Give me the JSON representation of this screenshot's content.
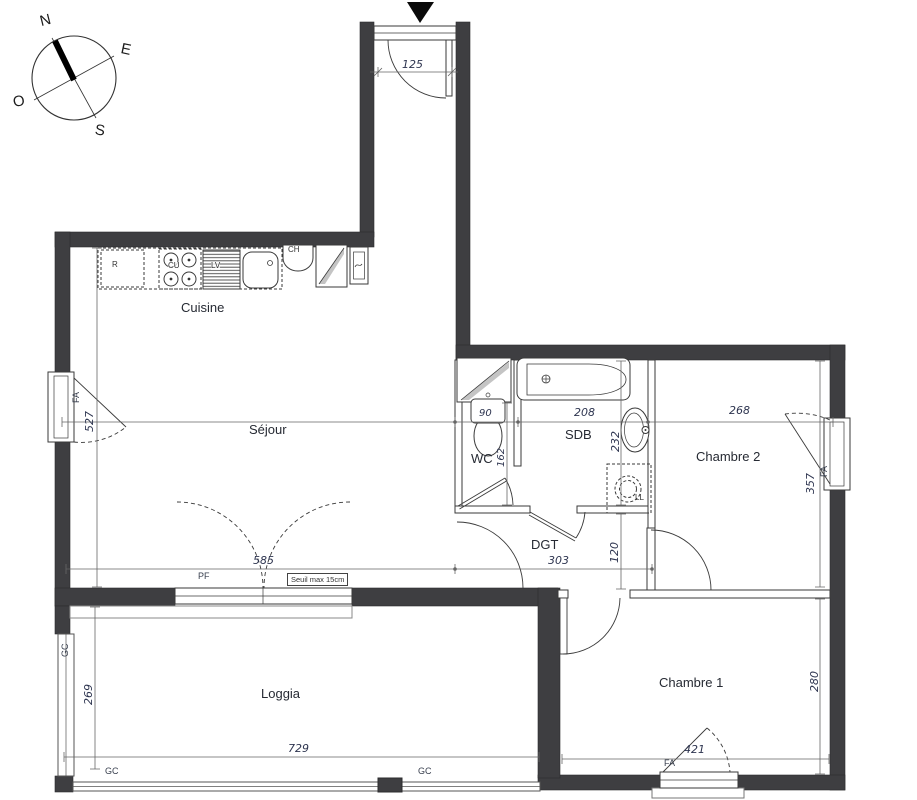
{
  "compass": {
    "north": "N",
    "east": "E",
    "west": "O",
    "south": "S"
  },
  "rooms": {
    "cuisine": "Cuisine",
    "sejour": "Séjour",
    "wc": "WC",
    "sdb": "SDB",
    "dgt": "DGT",
    "chambre2": "Chambre 2",
    "chambre1": "Chambre 1",
    "loggia": "Loggia"
  },
  "dimensions_cm": {
    "entrance_door": "125",
    "sejour_width": "585",
    "sejour_height": "527",
    "wc_width": "90",
    "wc_height": "162",
    "sdb_width": "208",
    "sdb_height": "232",
    "chambre2_width": "268",
    "chambre2_height": "357",
    "dgt_width": "303",
    "dgt_height": "120",
    "chambre1_width": "421",
    "chambre1_height": "280",
    "loggia_width": "729",
    "loggia_height": "269"
  },
  "openings": {
    "window_labels": [
      "FA",
      "FA",
      "FA"
    ],
    "french_door_label": "PF",
    "guardrail_labels": [
      "GC",
      "GC",
      "GC"
    ],
    "threshold_note": "Seuil max 15cm"
  },
  "appliances": {
    "fridge": "R",
    "cooktop": "CU",
    "dishwasher": "LV",
    "water_heater": "CH",
    "washing_machine": "LL"
  },
  "colors": {
    "wall": "#3e3e41",
    "line": "#3a3a3a",
    "dimension_text": "#2e3550",
    "label_text": "#262a33"
  }
}
